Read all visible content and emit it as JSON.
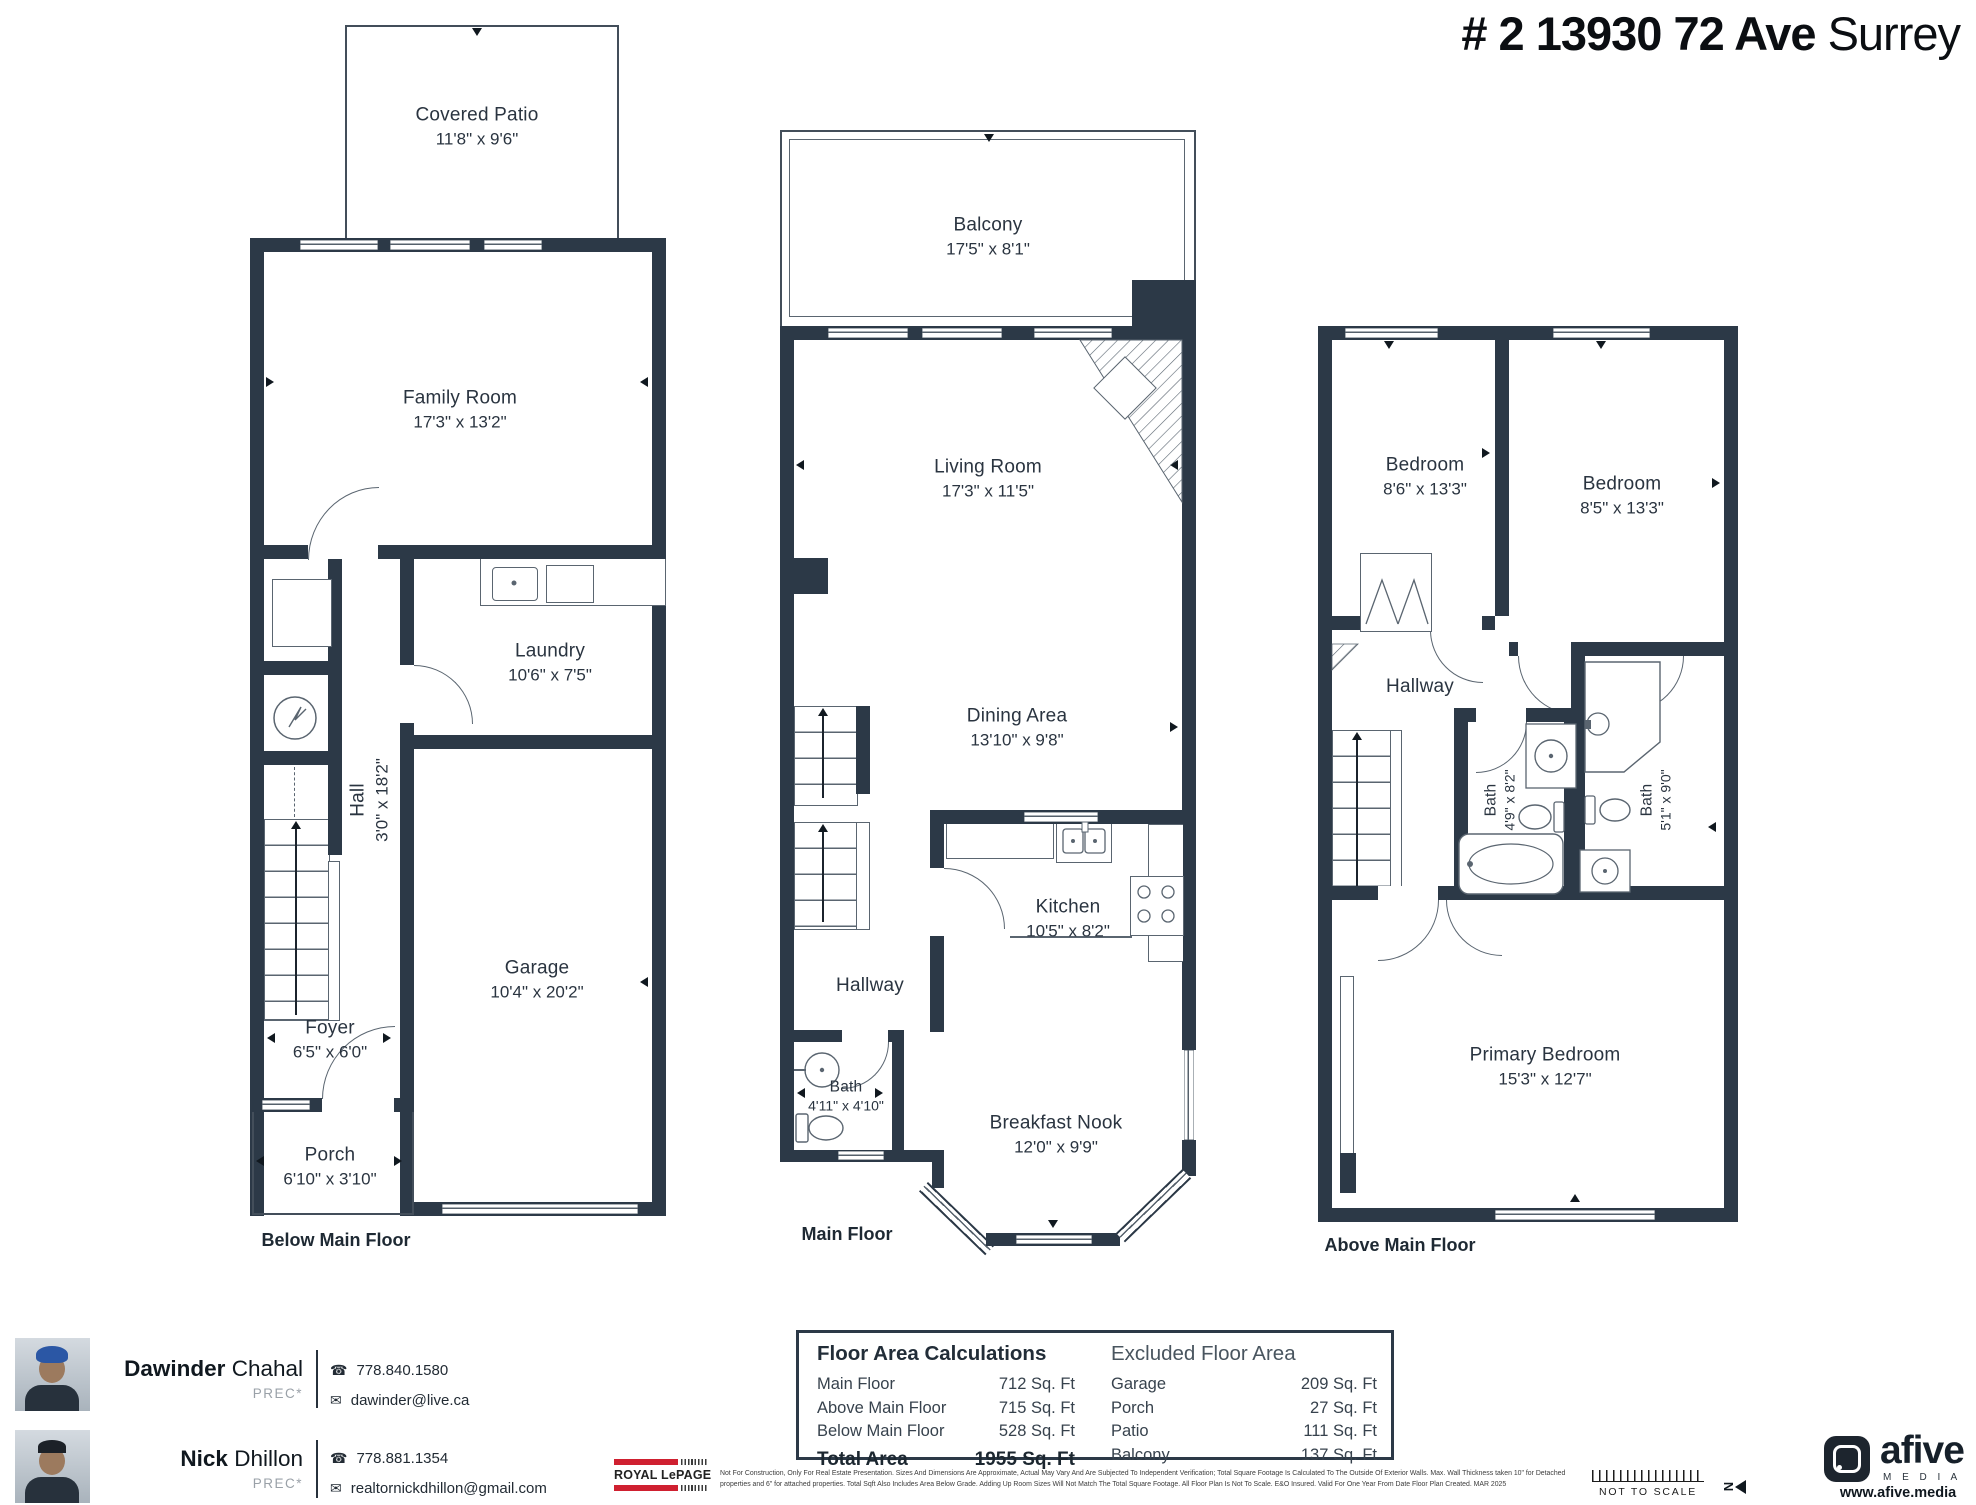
{
  "title": {
    "address": "# 2 13930 72 Ave",
    "city": "Surrey"
  },
  "captions": {
    "below": "Below Main Floor",
    "main": "Main Floor",
    "above": "Above Main Floor"
  },
  "rooms": {
    "covered_patio": {
      "name": "Covered Patio",
      "dims": "11'8\" x 9'6\""
    },
    "family": {
      "name": "Family Room",
      "dims": "17'3\" x 13'2\""
    },
    "laundry": {
      "name": "Laundry",
      "dims": "10'6\" x 7'5\""
    },
    "hall": {
      "name": "Hall",
      "dims": "3'0\" x 18'2\""
    },
    "garage": {
      "name": "Garage",
      "dims": "10'4\" x 20'2\""
    },
    "foyer": {
      "name": "Foyer",
      "dims": "6'5\" x 6'0\""
    },
    "porch": {
      "name": "Porch",
      "dims": "6'10\" x 3'10\""
    },
    "balcony": {
      "name": "Balcony",
      "dims": "17'5\" x 8'1\""
    },
    "living": {
      "name": "Living Room",
      "dims": "17'3\" x 11'5\""
    },
    "dining": {
      "name": "Dining Area",
      "dims": "13'10\" x 9'8\""
    },
    "kitchen": {
      "name": "Kitchen",
      "dims": "10'5\" x 8'2\""
    },
    "hallway_main": {
      "name": "Hallway"
    },
    "bath_main": {
      "name": "Bath",
      "dims": "4'11\" x 4'10\""
    },
    "nook": {
      "name": "Breakfast Nook",
      "dims": "12'0\" x 9'9\""
    },
    "bedroom1": {
      "name": "Bedroom",
      "dims": "8'6\" x 13'3\""
    },
    "bedroom2": {
      "name": "Bedroom",
      "dims": "8'5\" x 13'3\""
    },
    "hallway_above": {
      "name": "Hallway"
    },
    "bath1_above": {
      "name": "Bath",
      "dims": "4'9\" x 8'2\""
    },
    "bath2_above": {
      "name": "Bath",
      "dims": "5'1\" x 9'0\""
    },
    "primary": {
      "name": "Primary Bedroom",
      "dims": "15'3\" x 12'7\""
    }
  },
  "area_box": {
    "calc_title": "Floor Area Calculations",
    "rows": [
      {
        "label": "Main Floor",
        "value": "712 Sq. Ft"
      },
      {
        "label": "Above Main Floor",
        "value": "715 Sq. Ft"
      },
      {
        "label": "Below Main Floor",
        "value": "528 Sq. Ft"
      }
    ],
    "total_label": "Total Area",
    "total_value": "1955 Sq. Ft",
    "excluded_title": "Excluded Floor Area",
    "excluded_rows": [
      {
        "label": "Garage",
        "value": "209 Sq. Ft"
      },
      {
        "label": "Porch",
        "value": "27 Sq. Ft"
      },
      {
        "label": "Patio",
        "value": "111 Sq. Ft"
      },
      {
        "label": "Balcony",
        "value": "137 Sq. Ft"
      }
    ]
  },
  "agents": [
    {
      "first": "Dawinder",
      "last": " Chahal",
      "designation": "PREC*",
      "phone": "778.840.1580",
      "email": "dawinder@live.ca"
    },
    {
      "first": "Nick",
      "last": " Dhillon",
      "designation": "PREC*",
      "phone": "778.881.1354",
      "email": "realtornickdhillon@gmail.com"
    }
  ],
  "icons": {
    "phone": "☎",
    "mail": "✉"
  },
  "branding": {
    "royal_lepage": "ROYAL LePAGE",
    "disclaimer": "Not For Construction, Only For Real Estate Presentation. Sizes And Dimensions Are Approximate, Actual May Vary And Are Subjected To Independent Verification; Total Square Footage Is Calculated To The Outside Of Exterior Walls.  Max. Wall Thickness taken 10\" for Detached properties and 6\" for attached properties. Total Sqft Also Includes Area Below Grade. Adding Up Room Sizes Will Not Match The Total Square Footage. All Floor Plan Is Not To Scale. E&O Insured.  Valid For One Year From Date Floor Plan Created. MAR 2025",
    "not_to_scale": "NOT TO SCALE",
    "north": "N",
    "afive_name": "afive",
    "afive_media": "M E D I A",
    "afive_url": "www.afive.media"
  },
  "colors": {
    "wall": "#2c3947",
    "accent_red": "#cf2030",
    "text": "#27313c"
  }
}
